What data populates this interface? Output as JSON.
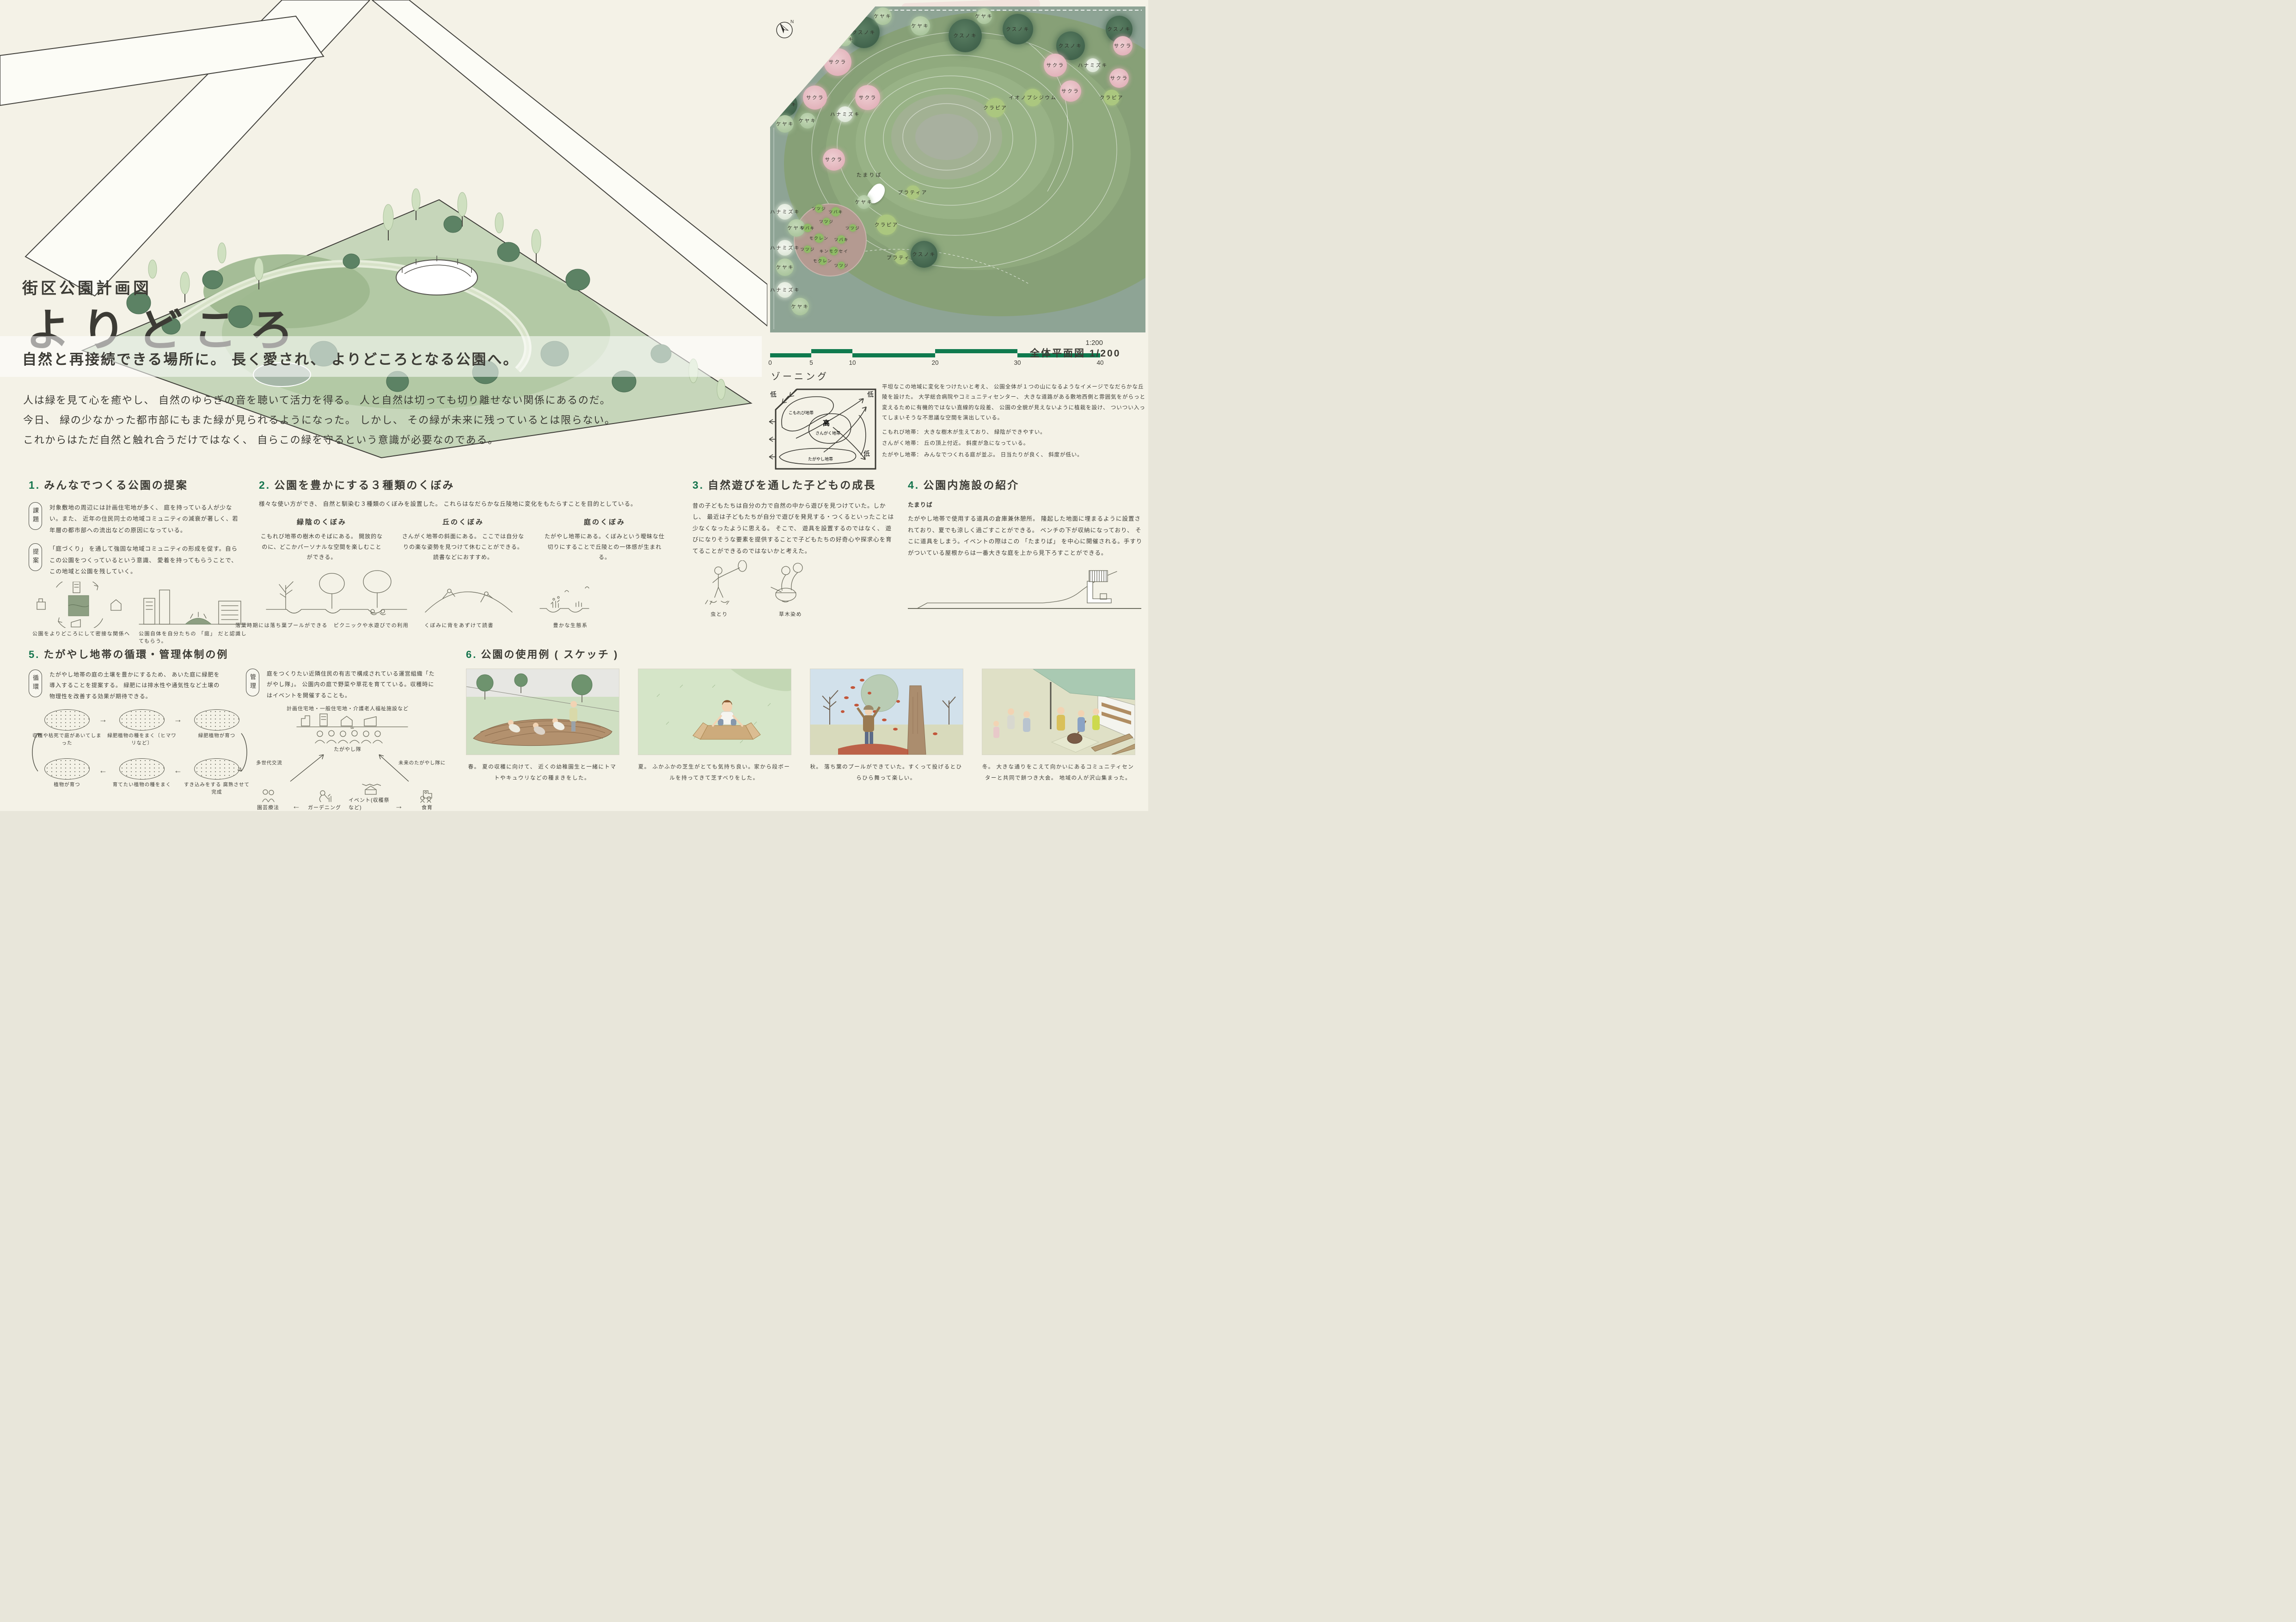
{
  "colors": {
    "background": "#f4f2e7",
    "accent_green": "#14744c",
    "scalebar_green": "#0f7a4e",
    "ink": "#3c3b35",
    "plan_outer": "#8ea495",
    "plan_hill": "#98b286",
    "tree_dark": "#4c7156",
    "tree_light": "#b8cfae",
    "tree_pink": "#e8bcc0",
    "tree_white": "#edf1e8",
    "ground_cover": "#abc77f",
    "garden_soil": "#b49a91"
  },
  "header": {
    "category": "街区公園計画図",
    "title": "よりどころ",
    "subtitle": "自然と再接続できる場所に。 長く愛され、 よりどころとなる公園へ。",
    "body_lines": [
      "人は緑を見て心を癒やし、 自然のゆらぎの音を聴いて活力を得る。 人と自然は切っても切り離せない関係にあるのだ。",
      "今日、 緑の少なかった都市部にもまた緑が見られるようになった。 しかし、 その緑が未来に残っているとは限らない。",
      "これからはただ自然と触れ合うだけではなく、 自らこの緑を守るという意識が必要なのである。"
    ]
  },
  "site_plan": {
    "compass": "N",
    "scale_ratio": "1:200",
    "plan_caption": "全体平面図  1/200",
    "scale_ticks": [
      "0",
      "5",
      "10",
      "20",
      "30",
      "40"
    ],
    "center_label": "たまりば",
    "trees": [
      {
        "s": "ケヤキ",
        "t": "light",
        "x": 11,
        "y": 7,
        "r": 26
      },
      {
        "s": "ケヤキ",
        "t": "light",
        "x": 19,
        "y": 4,
        "r": 24
      },
      {
        "s": "ケヤキ",
        "t": "light",
        "x": 8,
        "y": 14,
        "r": 22
      },
      {
        "s": "クスノキ",
        "t": "dark",
        "x": 25,
        "y": 8,
        "r": 34
      },
      {
        "s": "ケヤキ",
        "t": "light",
        "x": 30,
        "y": 3,
        "r": 19
      },
      {
        "s": "ケヤキ",
        "t": "light",
        "x": 40,
        "y": 6,
        "r": 21
      },
      {
        "s": "クスノキ",
        "t": "dark",
        "x": 52,
        "y": 9,
        "r": 36
      },
      {
        "s": "ケヤキ",
        "t": "light",
        "x": 57,
        "y": 3,
        "r": 17
      },
      {
        "s": "クスノキ",
        "t": "dark",
        "x": 66,
        "y": 7,
        "r": 33
      },
      {
        "s": "クスノキ",
        "t": "dark",
        "x": 80,
        "y": 12,
        "r": 31
      },
      {
        "s": "クスノキ",
        "t": "dark",
        "x": 93,
        "y": 7,
        "r": 29
      },
      {
        "s": "クスノキ",
        "t": "dark",
        "x": 5,
        "y": 16,
        "r": 29
      },
      {
        "s": "ケヤキ",
        "t": "light",
        "x": 4,
        "y": 22,
        "r": 21
      },
      {
        "s": "クスノキ",
        "t": "dark",
        "x": 4,
        "y": 30,
        "r": 27
      },
      {
        "s": "ケヤキ",
        "t": "light",
        "x": 4,
        "y": 36,
        "r": 19
      },
      {
        "s": "ケヤキ",
        "t": "light",
        "x": 10,
        "y": 35,
        "r": 17
      },
      {
        "s": "サクラ",
        "t": "pink",
        "x": 18,
        "y": 17,
        "r": 30
      },
      {
        "s": "ケヤキ",
        "t": "light",
        "x": 20,
        "y": 10,
        "r": 15
      },
      {
        "s": "サクラ",
        "t": "pink",
        "x": 12,
        "y": 28,
        "r": 26
      },
      {
        "s": "サクラ",
        "t": "pink",
        "x": 26,
        "y": 28,
        "r": 27
      },
      {
        "s": "ハナミズキ",
        "t": "white",
        "x": 20,
        "y": 33,
        "r": 17
      },
      {
        "s": "サクラ",
        "t": "pink",
        "x": 17,
        "y": 47,
        "r": 24
      },
      {
        "s": "ハナミズキ",
        "t": "white",
        "x": 4,
        "y": 63,
        "r": 17
      },
      {
        "s": "ケヤキ",
        "t": "light",
        "x": 7,
        "y": 68,
        "r": 19
      },
      {
        "s": "ハナミズキ",
        "t": "white",
        "x": 4,
        "y": 74,
        "r": 17
      },
      {
        "s": "ケヤキ",
        "t": "light",
        "x": 4,
        "y": 80,
        "r": 19
      },
      {
        "s": "ハナミズキ",
        "t": "white",
        "x": 4,
        "y": 87,
        "r": 17
      },
      {
        "s": "ケヤキ",
        "t": "light",
        "x": 8,
        "y": 92,
        "r": 19
      },
      {
        "s": "ケヤキ",
        "t": "light",
        "x": 25,
        "y": 60,
        "r": 15
      },
      {
        "s": "クラピア",
        "t": "ground",
        "x": 31,
        "y": 67,
        "r": 22
      },
      {
        "s": "プラティア",
        "t": "ground",
        "x": 38,
        "y": 57,
        "r": 15
      },
      {
        "s": "プラティア",
        "t": "ground",
        "x": 35,
        "y": 77,
        "r": 15
      },
      {
        "s": "クスノキ",
        "t": "dark",
        "x": 41,
        "y": 76,
        "r": 29
      },
      {
        "s": "サクラ",
        "t": "pink",
        "x": 76,
        "y": 18,
        "r": 25
      },
      {
        "s": "サクラ",
        "t": "pink",
        "x": 80,
        "y": 26,
        "r": 23
      },
      {
        "s": "イオノプシジウム",
        "t": "ground",
        "x": 70,
        "y": 28,
        "r": 19
      },
      {
        "s": "クラピア",
        "t": "ground",
        "x": 60,
        "y": 31,
        "r": 21
      },
      {
        "s": "ハナミズキ",
        "t": "white",
        "x": 86,
        "y": 18,
        "r": 15
      },
      {
        "s": "サクラ",
        "t": "pink",
        "x": 94,
        "y": 12,
        "r": 21
      },
      {
        "s": "サクラ",
        "t": "pink",
        "x": 93,
        "y": 22,
        "r": 21
      },
      {
        "s": "クラピア",
        "t": "ground",
        "x": 91,
        "y": 28,
        "r": 17
      },
      {
        "s": "ツツジ",
        "t": "shrub",
        "x": 13,
        "y": 62,
        "r": 9
      },
      {
        "s": "ツバキ",
        "t": "shrub",
        "x": 17.5,
        "y": 63,
        "r": 10
      },
      {
        "s": "ツツジ",
        "t": "shrub",
        "x": 15,
        "y": 66,
        "r": 8
      },
      {
        "s": "ツバキ",
        "t": "shrub",
        "x": 10,
        "y": 68,
        "r": 9
      },
      {
        "s": "ツツジ",
        "t": "shrub",
        "x": 22,
        "y": 68,
        "r": 8
      },
      {
        "s": "モクレン",
        "t": "shrub",
        "x": 13,
        "y": 71,
        "r": 10
      },
      {
        "s": "ツバキ",
        "t": "shrub",
        "x": 19,
        "y": 71.5,
        "r": 9
      },
      {
        "s": "ツツジ",
        "t": "shrub",
        "x": 10,
        "y": 74.5,
        "r": 8
      },
      {
        "s": "キンモクセイ",
        "t": "shrub",
        "x": 17,
        "y": 75,
        "r": 9
      },
      {
        "s": "モクレン",
        "t": "shrub",
        "x": 14,
        "y": 78,
        "r": 9
      },
      {
        "s": "ツツジ",
        "t": "shrub",
        "x": 19,
        "y": 79.5,
        "r": 8
      }
    ]
  },
  "zoning": {
    "title": "ゾーニング",
    "diagram": {
      "low": "低",
      "high": "高",
      "zone1": "こもれび地帯",
      "zone2": "さんがく地帯",
      "zone3": "たがやし地帯"
    },
    "paragraph": "平坦なこの地域に変化をつけたいと考え、 公園全体が１つの山になるようなイメージでなだらかな丘陵を設けた。 大学総合病院やコミュニティセンター、 大きな道路がある敷地西側と雰囲気をがらっと変えるために有機的ではない直線的な段差、 公園の全貌が見えないように植栽を設け、 ついつい入ってしまいそうな不思議な空間を演出している。",
    "definitions": [
      "こもれび地帯： 大きな樹木が生えており、 緑陰ができやすい。",
      "さんがく地帯： 丘の頂上付近。 斜度が急になっている。",
      "たがやし地帯： みんなでつくれる庭が並ぶ。 日当たりが良く、 斜度が低い。"
    ]
  },
  "section1": {
    "no": "1.",
    "title": "みんなでつくる公園の提案",
    "issue_label": "課題",
    "issue_text": "対象敷地の周辺には計画住宅地が多く、 庭を持っている人が少ない。また、 近年の住民同士の地域コミュニティの減衰が著しく、若年層の都市部への流出などの原因になっている。",
    "proposal_label": "提案",
    "proposal_text": "「庭づくり」 を通して強固な地域コミュニティの形成を促す。自らこの公園をつくっているという意識、 愛着を持ってもらうことで、この地域と公園を残していく。",
    "captions": [
      "公園をよりどころにして密接な関係へ",
      "公園自体を自分たちの 「庭」 だと認識してもらう。"
    ]
  },
  "section2": {
    "no": "2.",
    "title": "公園を豊かにする３種類のくぼみ",
    "intro": "様々な使い方ができ、 自然と馴染む３種類のくぼみを設置した。 これらはなだらかな丘陵地に変化をもたらすことを目的としている。",
    "columns": [
      {
        "title": "緑陰のくぼみ",
        "desc": "こもれび地帯の樹木のそばにある。 開放的なのに、どこかパーソナルな空間を楽しむことができる。"
      },
      {
        "title": "丘のくぼみ",
        "desc": "さんがく地帯の斜面にある。 ここでは自分なりの楽な姿勢を見つけて休むことができる。 読書などにおすすめ。"
      },
      {
        "title": "庭のくぼみ",
        "desc": "たがやし地帯にある。くぼみという曖昧な仕切りにすることで丘陵との一体感が生まれる。"
      }
    ],
    "captions": [
      "落葉時期には落ち葉プールができる",
      "ピクニックや水遊びでの利用",
      "くぼみに背をあずけて読書",
      "豊かな生態系"
    ]
  },
  "section3": {
    "no": "3.",
    "title": "自然遊びを通した子どもの成長",
    "text": "昔の子どもたちは自分の力で自然の中から遊びを見つけていた。しかし、 最近は子どもたちが自分で遊びを発見する・つくるといったことは少なくなったように思える。 そこで、 遊具を設置するのではなく、 遊びになりそうな要素を提供することで子どもたちの好奇心や探求心を育てることができるのではないかと考えた。",
    "captions": [
      "虫とり",
      "草木染め"
    ]
  },
  "section4": {
    "no": "4.",
    "title": "公園内施設の紹介",
    "subtitle": "たまりば",
    "text": "たがやし地帯で使用する道具の倉庫兼休憩所。 隆起した地面に埋まるように設置されており、夏でも涼しく過ごすことができる。 ベンチの下が収納になっており、 そこに道具をしまう。イベントの際はこの 「たまりば」 を中心に開催される。手すりがついている屋根からは一番大きな庭を上から見下ろすことができる。"
  },
  "section5": {
    "no": "5.",
    "title": "たがやし地帯の循環・管理体制の例",
    "cycle_label": "循環",
    "cycle_text": "たがやし地帯の庭の土壌を豊かにするため、 あいた庭に緑肥を導入することを提案する。 緑肥には排水性や通気性など土壌の物理性を改善する効果が期待できる。",
    "cycle_steps": [
      "収穫や枯死で庭があいてしまった",
      "緑肥植物の種をまく〔ヒマワリなど〕",
      "緑肥植物が育つ",
      "すき込みをする 腐熟させて完成",
      "育てたい植物の種をまく",
      "植物が育つ"
    ],
    "manage_label": "管理",
    "manage_text": "庭をつくりたい近隣住民の有志で構成されている運営組織「たがやし隊」。 公園内の庭で野菜や草花を育てている。収穫時にはイベントを開催することも。",
    "org": {
      "top": "計画住宅地・一般住宅地・介護老人福祉施設など",
      "team": "たがやし隊",
      "left_arrow": "多世代交流",
      "right_arrow": "未来のたがやし隊に",
      "bottom": [
        "園芸療法",
        "ガーデニング",
        "イベント(収穫祭など)",
        "食育"
      ]
    }
  },
  "section6": {
    "no": "6.",
    "title": "公園の使用例 ( スケッチ )",
    "sketches": [
      {
        "season": "spring",
        "caption": "春。 夏の収穫に向けて、 近くの幼稚園生と一緒にトマトやキュウリなどの種まきをした。"
      },
      {
        "season": "summer",
        "caption": "夏。 ふかふかの芝生がとても気持ち良い。家から段ボールを持ってきて芝すべりをした。"
      },
      {
        "season": "autumn",
        "caption": "秋。 落ち葉のプールができていた。すくって投げるとひらひら舞って楽しい。"
      },
      {
        "season": "winter",
        "caption": "冬。 大きな通りをこえて向かいにあるコミュニティセンターと共同で餅つき大会。 地域の人が沢山集まった。"
      }
    ]
  }
}
